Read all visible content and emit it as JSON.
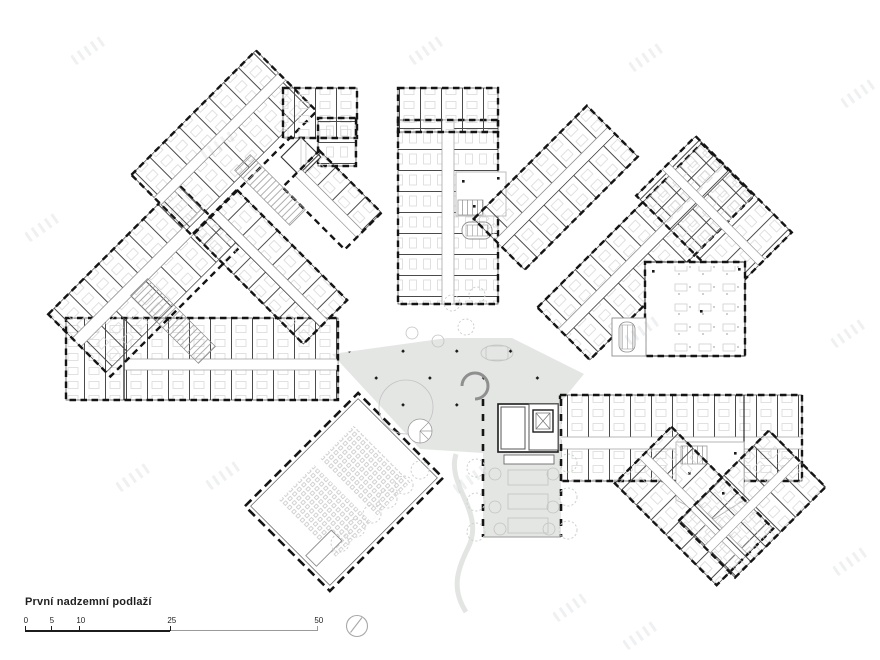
{
  "title": "První nadzemní podlaží",
  "scale_bar": {
    "labels": [
      "0",
      "5",
      "10",
      "25",
      "50"
    ]
  },
  "colors": {
    "area_fill_gray": "#e4e6e4",
    "wall": "#1a1a1a",
    "light_line": "#9a9a9a"
  },
  "icons": {
    "north_indicator": "compass-circle-icon"
  }
}
